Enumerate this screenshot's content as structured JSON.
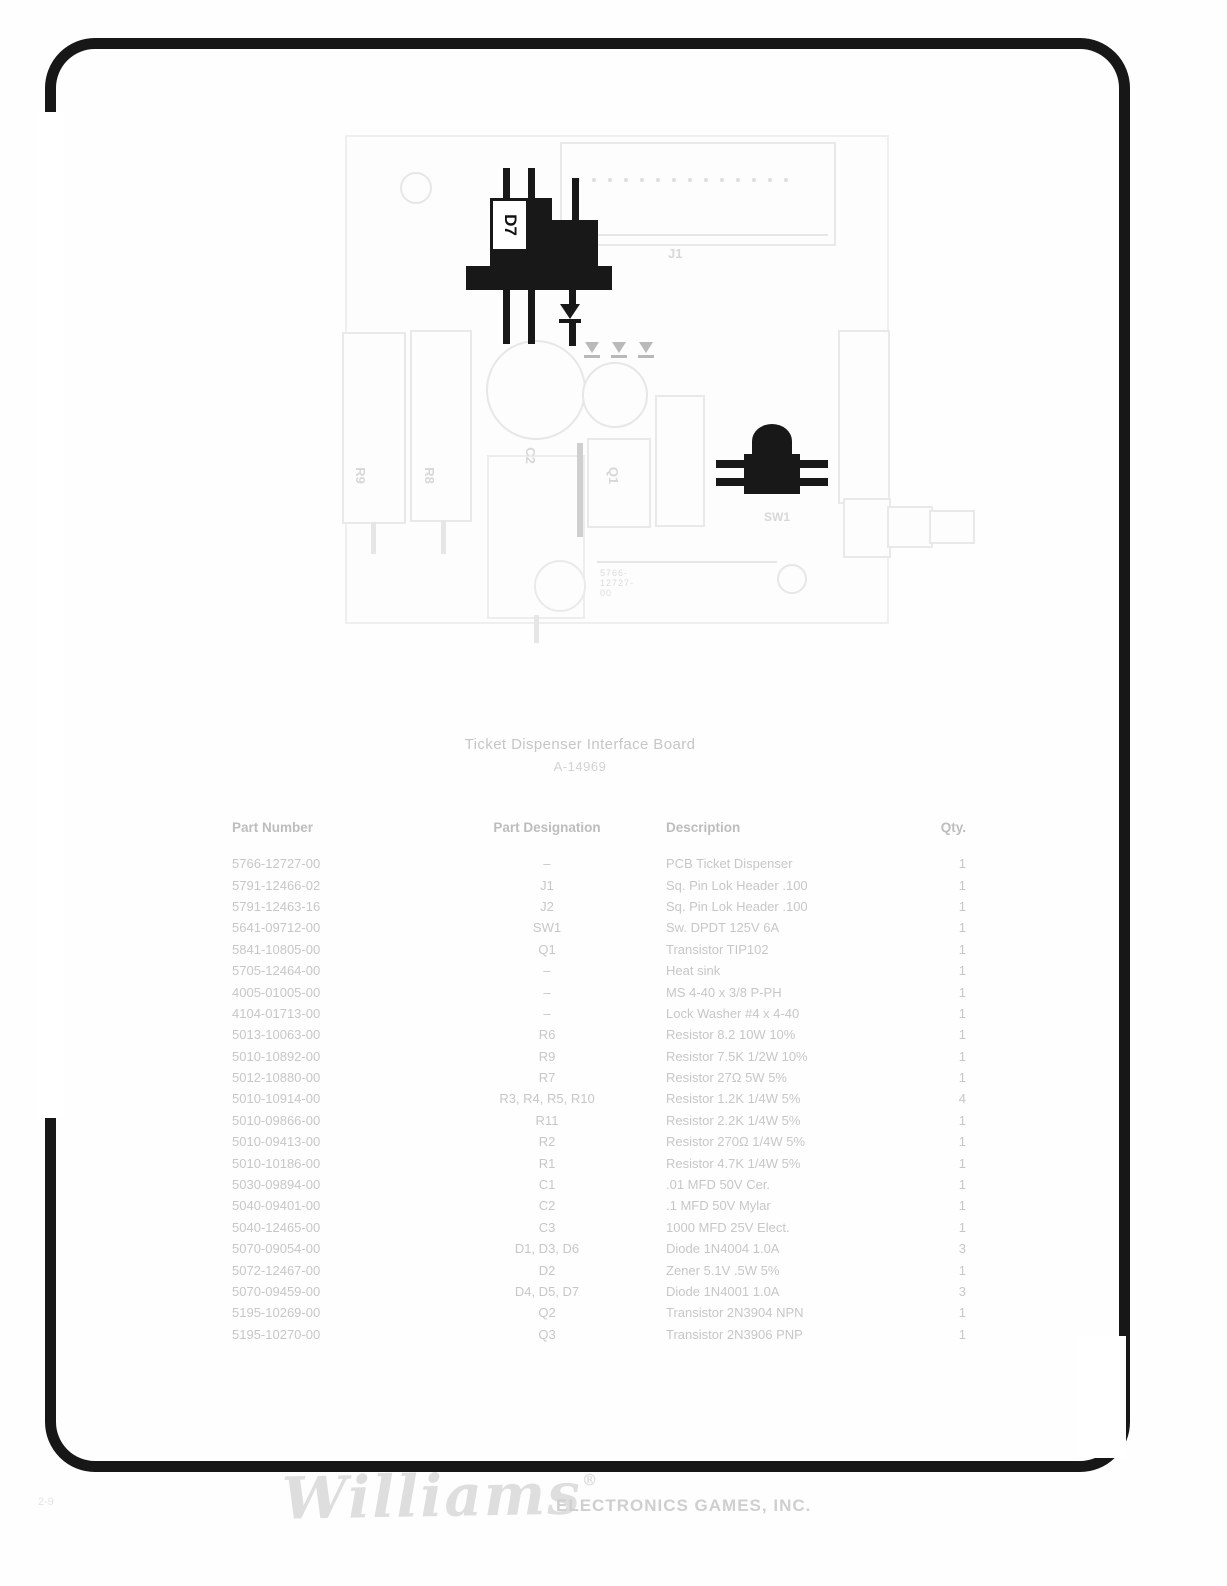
{
  "colors": {
    "paper": "#fefefe",
    "frame_ink": "#171717",
    "dark_component": "#181818",
    "faint_text": "#c7c7c7"
  },
  "diagram": {
    "board_number": "5766-12727-00",
    "labels": {
      "d7": "D7",
      "j1": "J1",
      "r9": "R9",
      "r8": "R8",
      "c2": "C2",
      "q1": "Q1",
      "sw1": "SW1"
    }
  },
  "title": {
    "line1": "Ticket Dispenser Interface Board",
    "line2": "A-14969"
  },
  "table": {
    "headers": [
      "Part Number",
      "Part Designation",
      "Description",
      "Qty."
    ],
    "rows": [
      {
        "part_number": "5766-12727-00",
        "designation": "–",
        "description": "PCB Ticket Dispenser",
        "qty": "1"
      },
      {
        "part_number": "5791-12466-02",
        "designation": "J1",
        "description": "Sq. Pin Lok Header .100",
        "qty": "1"
      },
      {
        "part_number": "5791-12463-16",
        "designation": "J2",
        "description": "Sq. Pin Lok Header .100",
        "qty": "1"
      },
      {
        "part_number": "5641-09712-00",
        "designation": "SW1",
        "description": "Sw. DPDT 125V 6A",
        "qty": "1"
      },
      {
        "part_number": "5841-10805-00",
        "designation": "Q1",
        "description": "Transistor TIP102",
        "qty": "1"
      },
      {
        "part_number": "5705-12464-00",
        "designation": "–",
        "description": "Heat sink",
        "qty": "1"
      },
      {
        "part_number": "4005-01005-00",
        "designation": "–",
        "description": "MS 4-40 x 3/8 P-PH",
        "qty": "1"
      },
      {
        "part_number": "4104-01713-00",
        "designation": "–",
        "description": "Lock Washer #4 x 4-40",
        "qty": "1"
      },
      {
        "part_number": "5013-10063-00",
        "designation": "R6",
        "description": "Resistor 8.2 10W 10%",
        "qty": "1"
      },
      {
        "part_number": "5010-10892-00",
        "designation": "R9",
        "description": "Resistor 7.5K 1/2W 10%",
        "qty": "1"
      },
      {
        "part_number": "5012-10880-00",
        "designation": "R7",
        "description": "Resistor 27Ω 5W 5%",
        "qty": "1"
      },
      {
        "part_number": "5010-10914-00",
        "designation": "R3, R4, R5, R10",
        "description": "Resistor 1.2K 1/4W 5%",
        "qty": "4"
      },
      {
        "part_number": "5010-09866-00",
        "designation": "R11",
        "description": "Resistor 2.2K 1/4W 5%",
        "qty": "1"
      },
      {
        "part_number": "5010-09413-00",
        "designation": "R2",
        "description": "Resistor 270Ω 1/4W 5%",
        "qty": "1"
      },
      {
        "part_number": "5010-10186-00",
        "designation": "R1",
        "description": "Resistor 4.7K 1/4W 5%",
        "qty": "1"
      },
      {
        "part_number": "5030-09894-00",
        "designation": "C1",
        "description": ".01 MFD 50V Cer.",
        "qty": "1"
      },
      {
        "part_number": "5040-09401-00",
        "designation": "C2",
        "description": ".1 MFD 50V Mylar",
        "qty": "1"
      },
      {
        "part_number": "5040-12465-00",
        "designation": "C3",
        "description": "1000 MFD 25V Elect.",
        "qty": "1"
      },
      {
        "part_number": "5070-09054-00",
        "designation": "D1, D3, D6",
        "description": "Diode 1N4004 1.0A",
        "qty": "3"
      },
      {
        "part_number": "5072-12467-00",
        "designation": "D2",
        "description": "Zener 5.1V .5W 5%",
        "qty": "1"
      },
      {
        "part_number": "5070-09459-00",
        "designation": "D4, D5, D7",
        "description": "Diode 1N4001 1.0A",
        "qty": "3"
      },
      {
        "part_number": "5195-10269-00",
        "designation": "Q2",
        "description": "Transistor 2N3904 NPN",
        "qty": "1"
      },
      {
        "part_number": "5195-10270-00",
        "designation": "Q3",
        "description": "Transistor 2N3906 PNP",
        "qty": "1"
      }
    ]
  },
  "footer": {
    "page_number": "2-9",
    "logo_script": "Williams",
    "logo_reg": "®",
    "logo_sub": "ELECTRONICS GAMES, INC."
  }
}
